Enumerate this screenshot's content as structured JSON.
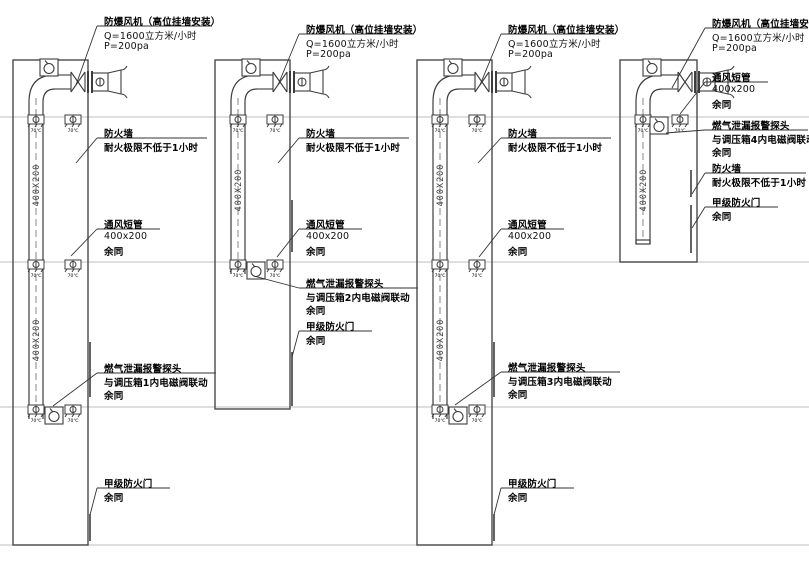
{
  "drawing": {
    "duct_size_label": "400X200",
    "damper_label": "70℃",
    "shafts": [
      {
        "fan_l1": "防爆风机（高位挂墙安装）",
        "fan_l2": "Q=1600立方米/小时",
        "fan_l3": "P=200pa",
        "firewall_l1": "防火墙",
        "firewall_l2": "耐火极限不低于1小时",
        "vent_l1": "通风短管",
        "vent_l2": "400x200",
        "vent_l3": "余同",
        "gas_l1": "燃气泄漏报警探头",
        "gas_l2": "与调压箱1内电磁阀联动",
        "gas_l3": "余同",
        "door_l1": "甲级防火门",
        "door_l2": "余同"
      },
      {
        "fan_l1": "防爆风机（高位挂墙安装）",
        "fan_l2": "Q=1600立方米/小时",
        "fan_l3": "P=200pa",
        "firewall_l1": "防火墙",
        "firewall_l2": "耐火极限不低于1小时",
        "vent_l1": "通风短管",
        "vent_l2": "400x200",
        "vent_l3": "余同",
        "gas_l1": "燃气泄漏报警探头",
        "gas_l2": "与调压箱2内电磁阀联动",
        "gas_l3": "余同",
        "door_l1": "甲级防火门",
        "door_l2": "余同"
      },
      {
        "fan_l1": "防爆风机（高位挂墙安装）",
        "fan_l2": "Q=1600立方米/小时",
        "fan_l3": "P=200pa",
        "firewall_l1": "防火墙",
        "firewall_l2": "耐火极限不低于1小时",
        "vent_l1": "通风短管",
        "vent_l2": "400x200",
        "vent_l3": "余同",
        "gas_l1": "燃气泄漏报警探头",
        "gas_l2": "与调压箱3内电磁阀联动",
        "gas_l3": "余同",
        "door_l1": "甲级防火门",
        "door_l2": "余同"
      },
      {
        "fan_l1": "防爆风机（高位挂墙安装）",
        "fan_l2": "Q=1600立方米/小时",
        "fan_l3": "P=200pa",
        "firewall_l1": "防火墙",
        "firewall_l2": "耐火极限不低于1小时",
        "vent_l1": "通风短管",
        "vent_l2": "400x200",
        "vent_l3": "余同",
        "gas_l1": "燃气泄漏报警探头",
        "gas_l2": "与调压箱4内电磁阀联动",
        "gas_l3": "余同",
        "door_l1": "甲级防火门",
        "door_l2": "余同"
      }
    ]
  }
}
